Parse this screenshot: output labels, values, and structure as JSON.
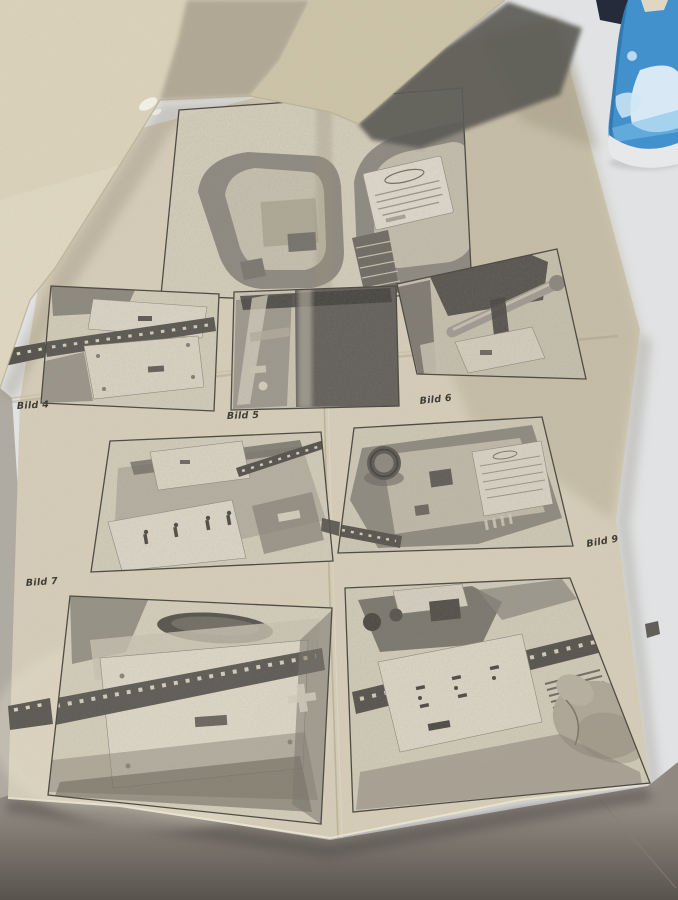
{
  "photo_subject": "instruction leaflet with figures",
  "figure_labels": {
    "bild4": "Bild 4",
    "bild5": "Bild 5",
    "bild6": "Bild 6",
    "bild7": "Bild 7",
    "bild9": "Bild 9"
  },
  "colors": {
    "paper": "#d5cdb8",
    "lifted_page": "#dbd3ba",
    "table_white": "#e1e2e3",
    "table_taupe": "#8f8880",
    "table_dark": "#4f4b45",
    "shadow_wedge": "#5d5b56",
    "navy_corner": "#252b3a",
    "can_blue": "#4291cd",
    "can_rim": "#e6e8e9",
    "print_ink": "#55524c",
    "label_ink": "#3c3a33"
  }
}
